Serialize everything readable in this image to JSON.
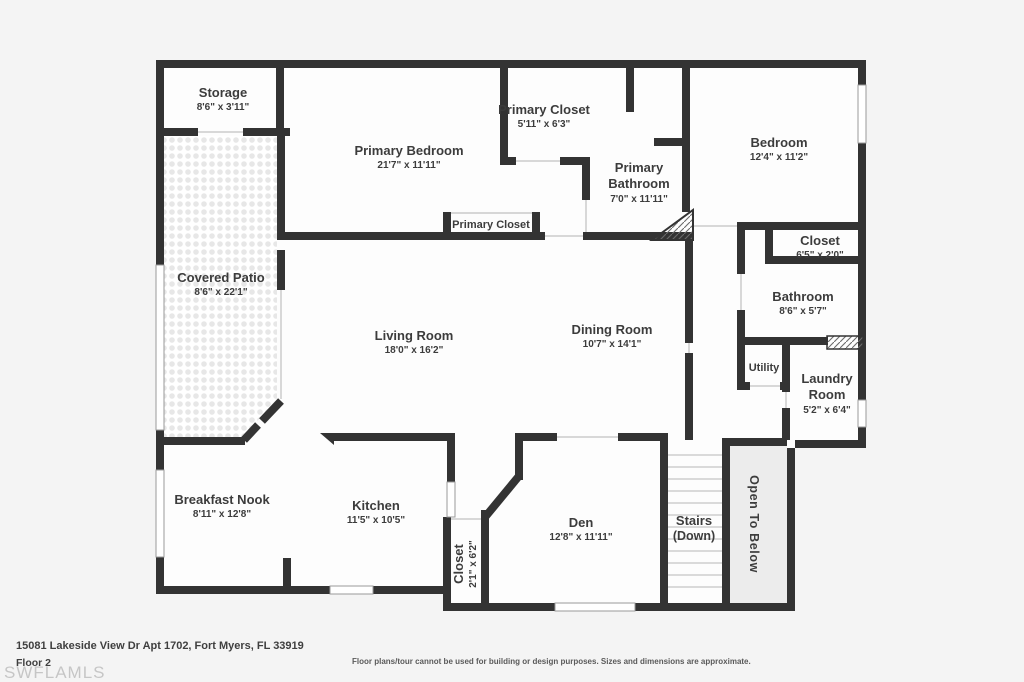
{
  "colors": {
    "wall": "#333333",
    "background": "#f4f4f4",
    "room_fill": "#fdfdfd",
    "open_below_fill": "#ececec",
    "label_text": "#3c3c3c"
  },
  "rooms": [
    {
      "id": "storage",
      "label": "Storage",
      "dims": "8'6\" x 3'11\""
    },
    {
      "id": "primary-bedroom",
      "label": "Primary Bedroom",
      "dims": "21'7\" x 11'11\""
    },
    {
      "id": "primary-closet",
      "label": "Primary Closet",
      "dims": "5'11\" x 6'3\""
    },
    {
      "id": "primary-bathroom",
      "label": "Primary Bathroom",
      "dims": "7'0\" x 11'11\""
    },
    {
      "id": "bedroom",
      "label": "Bedroom",
      "dims": "12'4\" x 11'2\""
    },
    {
      "id": "primary-closet-2",
      "label": "Primary Closet",
      "dims": ""
    },
    {
      "id": "covered-patio",
      "label": "Covered Patio",
      "dims": "8'6\" x 22'1\""
    },
    {
      "id": "closet-bedroom",
      "label": "Closet",
      "dims": "6'5\" x 2'0\""
    },
    {
      "id": "bathroom",
      "label": "Bathroom",
      "dims": "8'6\" x 5'7\""
    },
    {
      "id": "living-room",
      "label": "Living Room",
      "dims": "18'0\" x 16'2\""
    },
    {
      "id": "dining-room",
      "label": "Dining Room",
      "dims": "10'7\" x 14'1\""
    },
    {
      "id": "utility",
      "label": "Utility",
      "dims": ""
    },
    {
      "id": "laundry-room",
      "label": "Laundry Room",
      "dims": "5'2\" x 6'4\""
    },
    {
      "id": "breakfast-nook",
      "label": "Breakfast Nook",
      "dims": "8'11\" x 12'8\""
    },
    {
      "id": "kitchen",
      "label": "Kitchen",
      "dims": "11'5\" x 10'5\""
    },
    {
      "id": "closet-kitchen",
      "label": "Closet",
      "dims": "2'1\" x 6'2\""
    },
    {
      "id": "den",
      "label": "Den",
      "dims": "12'8\" x 11'11\""
    },
    {
      "id": "stairs",
      "label": "Stairs",
      "dims": "(Down)"
    },
    {
      "id": "open-to-below",
      "label": "Open To Below",
      "dims": ""
    }
  ],
  "footer": {
    "address": "15081 Lakeside View Dr Apt 1702, Fort Myers, FL 33919",
    "floor_label": "Floor 2",
    "watermark": "SWFLAMLS",
    "disclaimer": "Floor plans/tour cannot be used for building or design purposes. Sizes and dimensions are approximate."
  }
}
